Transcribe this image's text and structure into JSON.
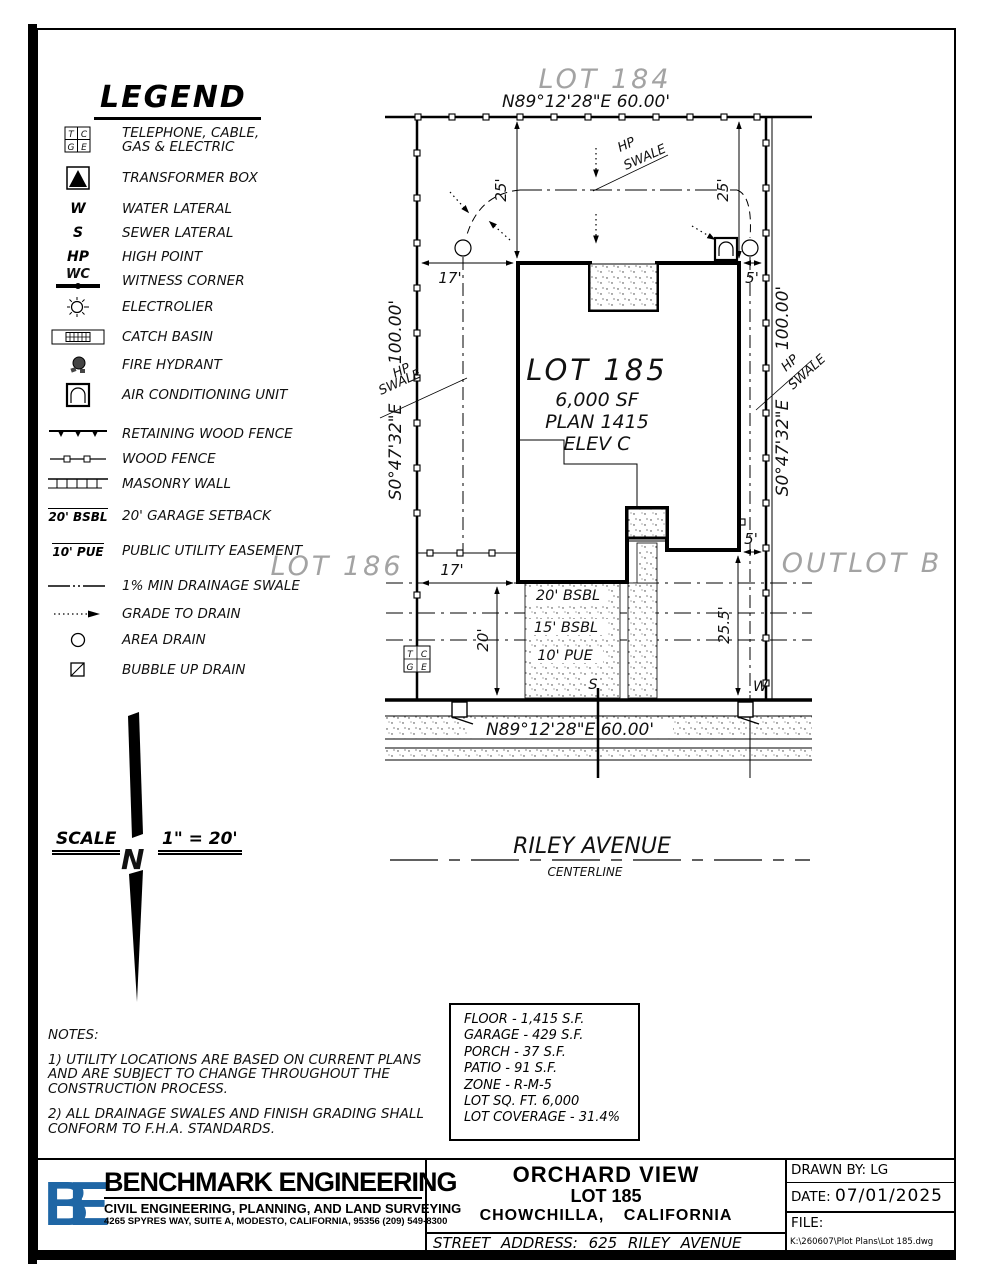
{
  "legend": {
    "title": "LEGEND",
    "tcge": {
      "t": "T",
      "c": "C",
      "g": "G",
      "e": "E"
    },
    "items": [
      {
        "label": "TELEPHONE, CABLE,",
        "label2": "GAS & ELECTRIC"
      },
      {
        "label": "TRANSFORMER BOX"
      },
      {
        "sym": "W",
        "label": "WATER LATERAL"
      },
      {
        "sym": "S",
        "label": "SEWER LATERAL"
      },
      {
        "sym": "HP",
        "label": "HIGH POINT"
      },
      {
        "sym": "WC",
        "label": "WITNESS CORNER"
      },
      {
        "label": "ELECTROLIER"
      },
      {
        "label": "CATCH BASIN"
      },
      {
        "label": "FIRE HYDRANT"
      },
      {
        "label": "AIR CONDITIONING UNIT"
      },
      {
        "label": "RETAINING WOOD FENCE"
      },
      {
        "label": "WOOD FENCE"
      },
      {
        "label": "MASONRY WALL"
      },
      {
        "sym": "20' BSBL",
        "label": "20' GARAGE SETBACK"
      },
      {
        "sym": "10' PUE",
        "label": "PUBLIC UTILITY EASEMENT"
      },
      {
        "label": "1% MIN DRAINAGE SWALE"
      },
      {
        "label": "GRADE TO DRAIN"
      },
      {
        "label": "AREA DRAIN"
      },
      {
        "label": "BUBBLE UP DRAIN"
      }
    ]
  },
  "plot": {
    "lot184": "LOT 184",
    "lot185": "LOT 185",
    "lot185_sf": "6,000 SF",
    "lot185_plan": "PLAN 1415",
    "lot185_elev": "ELEV C",
    "lot186": "LOT 186",
    "outlot": "OUTLOT B",
    "bearing": "N89°12'28\"E   60.00'",
    "side_bearing": "S0°47'32\"E",
    "side_len": "100.00'",
    "hp": "HP",
    "swale": "SWALE",
    "d25": "25'",
    "d17": "17'",
    "d5": "5'",
    "d20": "20'",
    "d255": "25.5'",
    "bsbl20": "20' BSBL",
    "bsbl15": "15' BSBL",
    "pue10": "10' PUE",
    "s": "S",
    "w": "W"
  },
  "street": {
    "name": "RILEY AVENUE",
    "centerline": "CENTERLINE"
  },
  "scalebar": {
    "label": "SCALE",
    "value": "1\" = 20'",
    "north": "N"
  },
  "notes": {
    "title": "NOTES:",
    "l1": "1) UTILITY LOCATIONS ARE BASED ON CURRENT PLANS",
    "l2": "AND ARE SUBJECT TO CHANGE THROUGHOUT THE",
    "l3": "CONSTRUCTION PROCESS.",
    "l4": "2) ALL DRAINAGE SWALES AND FINISH GRADING SHALL",
    "l5": "CONFORM TO F.H.A. STANDARDS."
  },
  "table": {
    "rows": [
      "FLOOR - 1,415 S.F.",
      "GARAGE - 429 S.F.",
      "PORCH - 37 S.F.",
      "PATIO - 91 S.F.",
      "ZONE - R-M-5",
      "LOT SQ. FT. 6,000",
      "LOT COVERAGE - 31.4%"
    ]
  },
  "title_block": {
    "logo": "BE",
    "logo_color": "#1f66a5",
    "company": "BENCHMARK ENGINEERING",
    "tagline": "CIVIL ENGINEERING, PLANNING, AND LAND SURVEYING",
    "address": "4265 SPYRES WAY, SUITE A, MODESTO, CALIFORNIA, 95356    (209) 549-8300",
    "project": "ORCHARD VIEW",
    "lot": "LOT 185",
    "city": "CHOWCHILLA, CALIFORNIA",
    "street_row": "STREET    ADDRESS:  625  RILEY  AVENUE",
    "drawn_by": "DRAWN BY: LG",
    "date_label": "DATE:",
    "date": "07/01/2025",
    "file_label": "FILE:",
    "file_path": "K:\\260607\\Plot Plans\\Lot 185.dwg"
  }
}
